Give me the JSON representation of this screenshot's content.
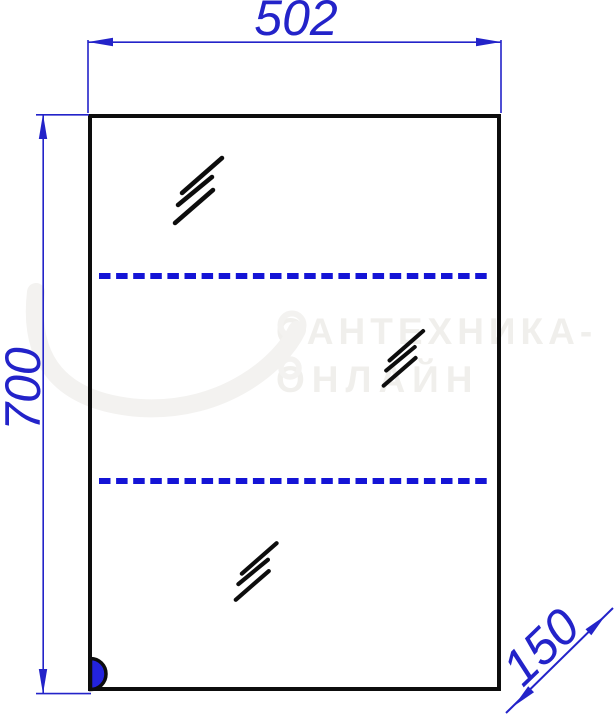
{
  "dimension_labels": {
    "width": "502",
    "height": "700",
    "depth": "150"
  },
  "watermark": {
    "line1": "САНТЕХНИКА-",
    "line2": "ОНЛАЙН"
  },
  "colors": {
    "dimension_blue": "#2323c9",
    "shelf_dash_blue": "#1414d6",
    "outline_black": "#0d0d0d",
    "hinge_fill_blue": "#2323dd",
    "watermark_gray": "#f0efec"
  }
}
